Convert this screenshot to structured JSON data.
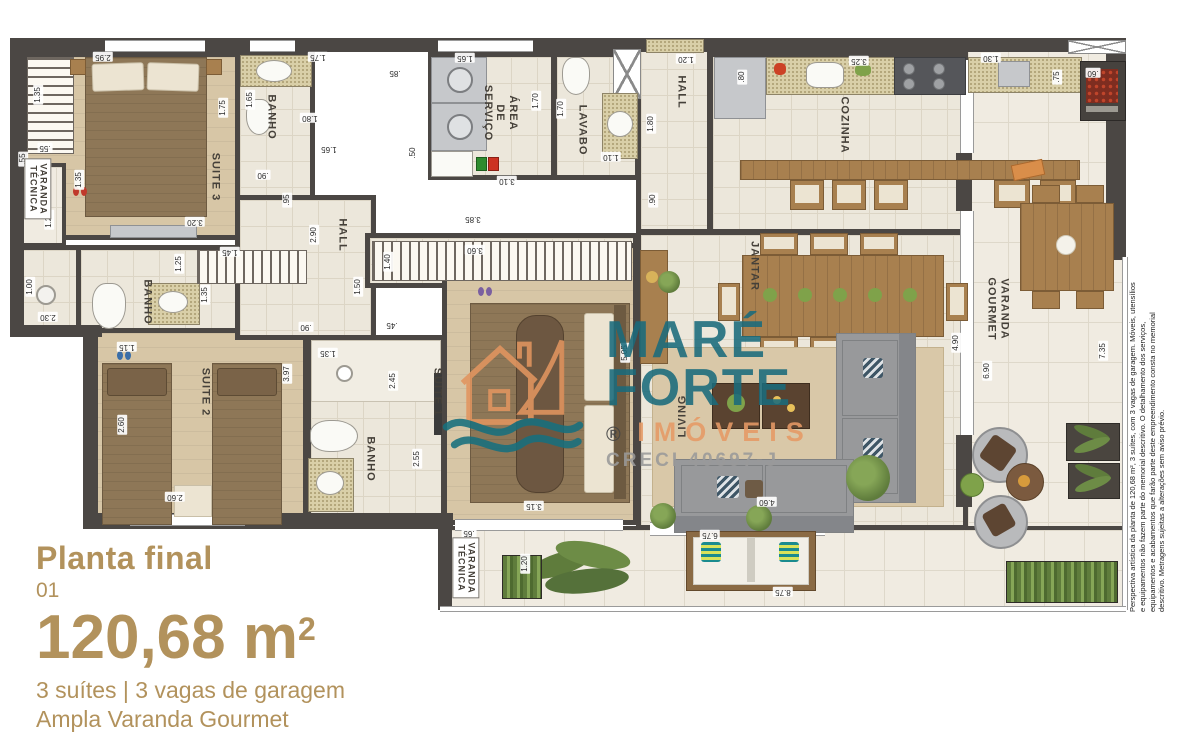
{
  "info": {
    "title": "Planta final",
    "number": "01",
    "area": "120,68 m",
    "area_sup": "2",
    "features": "3 suítes  | 3 vagas de garagem",
    "subtitle": "Ampla Varanda Gourmet"
  },
  "watermark": {
    "brand_top": "MARÉ",
    "brand_bottom": "FORTE",
    "brand_sub": "IMÓVEIS",
    "registered": "®",
    "creci": "CRECI 40697-J",
    "teal": "#1a6b7c",
    "orange": "#e69a66"
  },
  "disclaimer": "Perspectiva artística da planta de 120,68 m², 3 suítes, com 3 vagas de garagem. Móveis, utensílios e equipamentos não fazem parte do memorial descritivo. O detalhamento dos serviços, equipamentos e acabamentos que farão parte deste empreendimento consta no memorial descritivo. Metragens sujeitas a alterações sem aviso prévio.",
  "plan": {
    "room_labels": [
      {
        "text": "SUITE 3",
        "x": 205,
        "y": 142,
        "rot": 90
      },
      {
        "text": "BANHO",
        "x": 261,
        "y": 82,
        "rot": 90
      },
      {
        "text": "VARANDA\nTÉCNICA",
        "x": 28,
        "y": 154,
        "rot": 90,
        "boxed": true
      },
      {
        "text": "BANHO",
        "x": 137,
        "y": 267,
        "rot": 90
      },
      {
        "text": "SUITE 2",
        "x": 195,
        "y": 357,
        "rot": 90
      },
      {
        "text": "HALL",
        "x": 332,
        "y": 200,
        "rot": 90
      },
      {
        "text": "ÁREA\nDE\nSERVIÇO",
        "x": 490,
        "y": 78,
        "rot": 90
      },
      {
        "text": "LAVABO",
        "x": 572,
        "y": 95,
        "rot": 90
      },
      {
        "text": "HALL",
        "x": 671,
        "y": 57,
        "rot": 90
      },
      {
        "text": "COZINHA",
        "x": 834,
        "y": 90,
        "rot": 90
      },
      {
        "text": "SUITE 1",
        "x": 427,
        "y": 357,
        "rot": 90
      },
      {
        "text": "BANHO",
        "x": 360,
        "y": 424,
        "rot": 90
      },
      {
        "text": "JANTAR",
        "x": 744,
        "y": 231,
        "rot": 90
      },
      {
        "text": "LIVING",
        "x": 673,
        "y": 381,
        "rot": 270
      },
      {
        "text": "VARANDA\nGOURMET",
        "x": 988,
        "y": 274,
        "rot": 90
      },
      {
        "text": "VARANDA\nTÉCNICA",
        "x": 456,
        "y": 533,
        "rot": 90,
        "boxed": true
      }
    ],
    "dim_labels": [
      {
        "text": "2.95",
        "x": 93,
        "y": 22,
        "rot": 180
      },
      {
        "text": "1.35",
        "x": 28,
        "y": 60,
        "rot": 270
      },
      {
        "text": ".55",
        "x": 13,
        "y": 124,
        "rot": 270
      },
      {
        "text": ".55",
        "x": 35,
        "y": 113,
        "rot": 180
      },
      {
        "text": "1.25",
        "x": 39,
        "y": 185,
        "rot": 270
      },
      {
        "text": "1.35",
        "x": 69,
        "y": 145,
        "rot": 270
      },
      {
        "text": "3.20",
        "x": 185,
        "y": 187,
        "rot": 180
      },
      {
        "text": "1.75",
        "x": 213,
        "y": 73,
        "rot": 270
      },
      {
        "text": "1.75",
        "x": 308,
        "y": 22,
        "rot": 180
      },
      {
        "text": "1.65",
        "x": 240,
        "y": 65,
        "rot": 270
      },
      {
        "text": "1.80",
        "x": 300,
        "y": 83,
        "rot": 180
      },
      {
        "text": ".90",
        "x": 253,
        "y": 140,
        "rot": 180
      },
      {
        "text": ".95",
        "x": 277,
        "y": 165,
        "rot": 270
      },
      {
        "text": "2.90",
        "x": 304,
        "y": 200,
        "rot": 270
      },
      {
        "text": "1.45",
        "x": 220,
        "y": 217,
        "rot": 180
      },
      {
        "text": "1.25",
        "x": 169,
        "y": 229,
        "rot": 270
      },
      {
        "text": "1.35",
        "x": 195,
        "y": 260,
        "rot": 270
      },
      {
        "text": "1.00",
        "x": 20,
        "y": 252,
        "rot": 270
      },
      {
        "text": "2.30",
        "x": 38,
        "y": 282,
        "rot": 180
      },
      {
        "text": "1.15",
        "x": 117,
        "y": 312,
        "rot": 180
      },
      {
        "text": "2.60",
        "x": 112,
        "y": 390,
        "rot": 270
      },
      {
        "text": "2.60",
        "x": 165,
        "y": 462,
        "rot": 180
      },
      {
        "text": "3.97",
        "x": 277,
        "y": 339,
        "rot": 270
      },
      {
        "text": ".90",
        "x": 296,
        "y": 292,
        "rot": 180
      },
      {
        "text": "1.50",
        "x": 348,
        "y": 252,
        "rot": 270
      },
      {
        "text": "3.85",
        "x": 463,
        "y": 184,
        "rot": 180
      },
      {
        "text": "3.60",
        "x": 465,
        "y": 215,
        "rot": 180
      },
      {
        "text": "1.40",
        "x": 378,
        "y": 227,
        "rot": 270
      },
      {
        "text": ".45",
        "x": 382,
        "y": 290,
        "rot": 180
      },
      {
        "text": "1.35",
        "x": 318,
        "y": 318,
        "rot": 180
      },
      {
        "text": "2.45",
        "x": 383,
        "y": 346,
        "rot": 270
      },
      {
        "text": "2.55",
        "x": 407,
        "y": 424,
        "rot": 270
      },
      {
        "text": "3.15",
        "x": 524,
        "y": 471,
        "rot": 180
      },
      {
        "text": ".65",
        "x": 459,
        "y": 498,
        "rot": 180
      },
      {
        "text": "5.05",
        "x": 615,
        "y": 318,
        "rot": 270
      },
      {
        "text": "1.65",
        "x": 455,
        "y": 23,
        "rot": 180
      },
      {
        "text": ".85",
        "x": 385,
        "y": 38,
        "rot": 180
      },
      {
        "text": "1.65",
        "x": 319,
        "y": 114,
        "rot": 180
      },
      {
        "text": ".50",
        "x": 403,
        "y": 118,
        "rot": 270
      },
      {
        "text": "1.70",
        "x": 526,
        "y": 66,
        "rot": 270
      },
      {
        "text": "1.70",
        "x": 551,
        "y": 74,
        "rot": 270
      },
      {
        "text": "1.10",
        "x": 601,
        "y": 122,
        "rot": 180
      },
      {
        "text": "3.10",
        "x": 497,
        "y": 146,
        "rot": 180
      },
      {
        "text": "1.20",
        "x": 676,
        "y": 24,
        "rot": 180
      },
      {
        "text": "1.80",
        "x": 641,
        "y": 89,
        "rot": 270
      },
      {
        "text": ".90",
        "x": 643,
        "y": 165,
        "rot": 270
      },
      {
        "text": ".80",
        "x": 732,
        "y": 42,
        "rot": 270
      },
      {
        "text": "3.25",
        "x": 849,
        "y": 26,
        "rot": 180
      },
      {
        "text": "1.30",
        "x": 981,
        "y": 23,
        "rot": 180
      },
      {
        "text": ".75",
        "x": 1047,
        "y": 42,
        "rot": 270
      },
      {
        "text": ".60",
        "x": 1083,
        "y": 38,
        "rot": 180
      },
      {
        "text": "4.90",
        "x": 946,
        "y": 308,
        "rot": 270
      },
      {
        "text": "6.90",
        "x": 977,
        "y": 336,
        "rot": 270
      },
      {
        "text": "7.35",
        "x": 1093,
        "y": 316,
        "rot": 270
      },
      {
        "text": "4.60",
        "x": 757,
        "y": 467,
        "rot": 180
      },
      {
        "text": "6.75",
        "x": 700,
        "y": 500,
        "rot": 180
      },
      {
        "text": "8.75",
        "x": 773,
        "y": 557,
        "rot": 180
      },
      {
        "text": "1.20",
        "x": 515,
        "y": 529,
        "rot": 270
      }
    ]
  }
}
